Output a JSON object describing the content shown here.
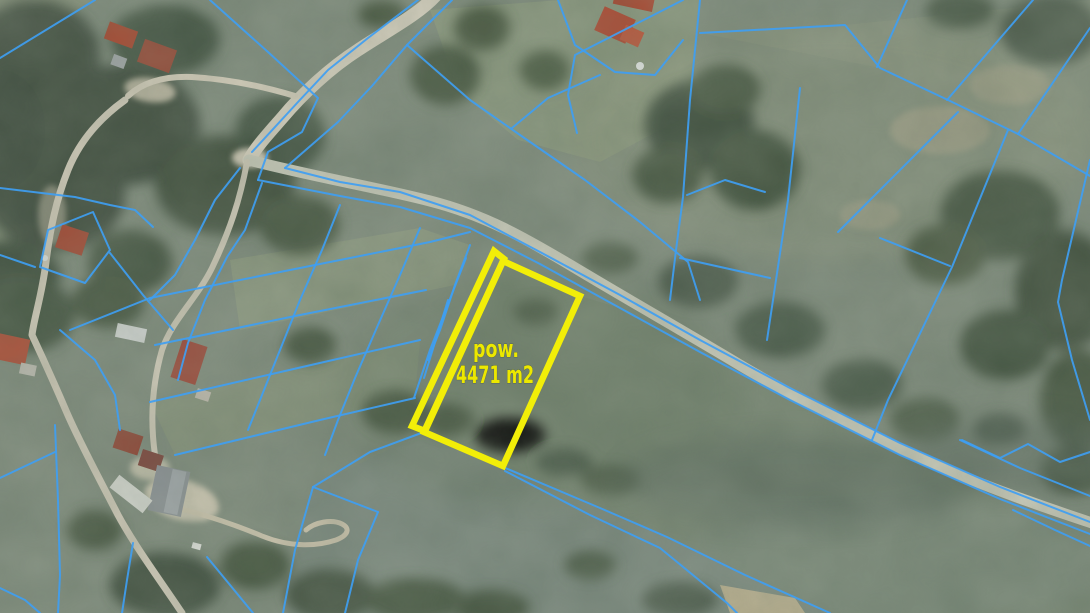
{
  "map": {
    "name": "aerial-cadastral-map",
    "highlighted_parcel": {
      "label_line1": "pow.",
      "label_line2": "4471 m2",
      "area_value": "4471",
      "area_unit": "m2"
    },
    "colors": {
      "parcel-boundary-blue": "#3f9ef2",
      "parcel-highlight-yellow": "#f2ee08",
      "area-label-yellow": "#ece800"
    }
  }
}
